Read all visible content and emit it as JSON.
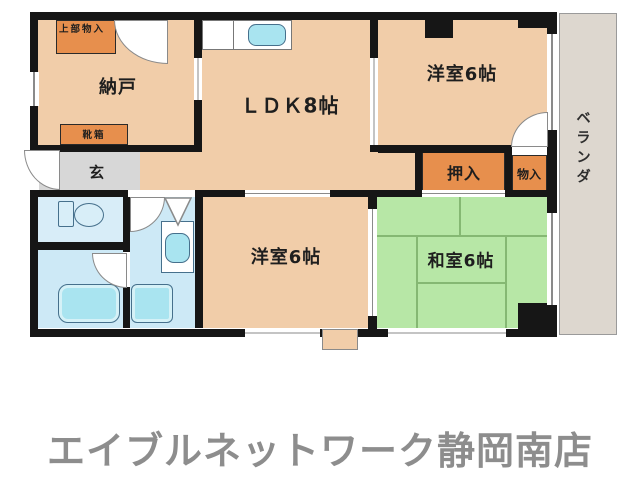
{
  "floorplan": {
    "labels": {
      "nando": "納戸",
      "ldk": "ＬＤＫ8帖",
      "yoshitsu_top": "洋室6帖",
      "yoshitsu_bottom": "洋室6帖",
      "washitsu": "和室6帖",
      "oshiire": "押入",
      "monoire": "物入",
      "genkan": "玄",
      "veranda": "ベランダ",
      "joubu_monoire": "上部物入",
      "kutsubako": "靴箱"
    },
    "colors": {
      "room_peach": "#f1cda9",
      "closet_orange": "#e78f4d",
      "tatami_green": "#b7e7a6",
      "tatami_line": "#85b873",
      "wet_area_blue": "#cde9f6",
      "fixture_cyan": "#a9e4f0",
      "fixture_outline": "#46708c",
      "genkan_gray": "#d7d7d7",
      "veranda_beige": "#ddd7cf",
      "wall_black": "#161616",
      "footer_gray": "#8d8d8d"
    }
  },
  "footer": {
    "store_name": "エイブルネットワーク静岡南店"
  }
}
